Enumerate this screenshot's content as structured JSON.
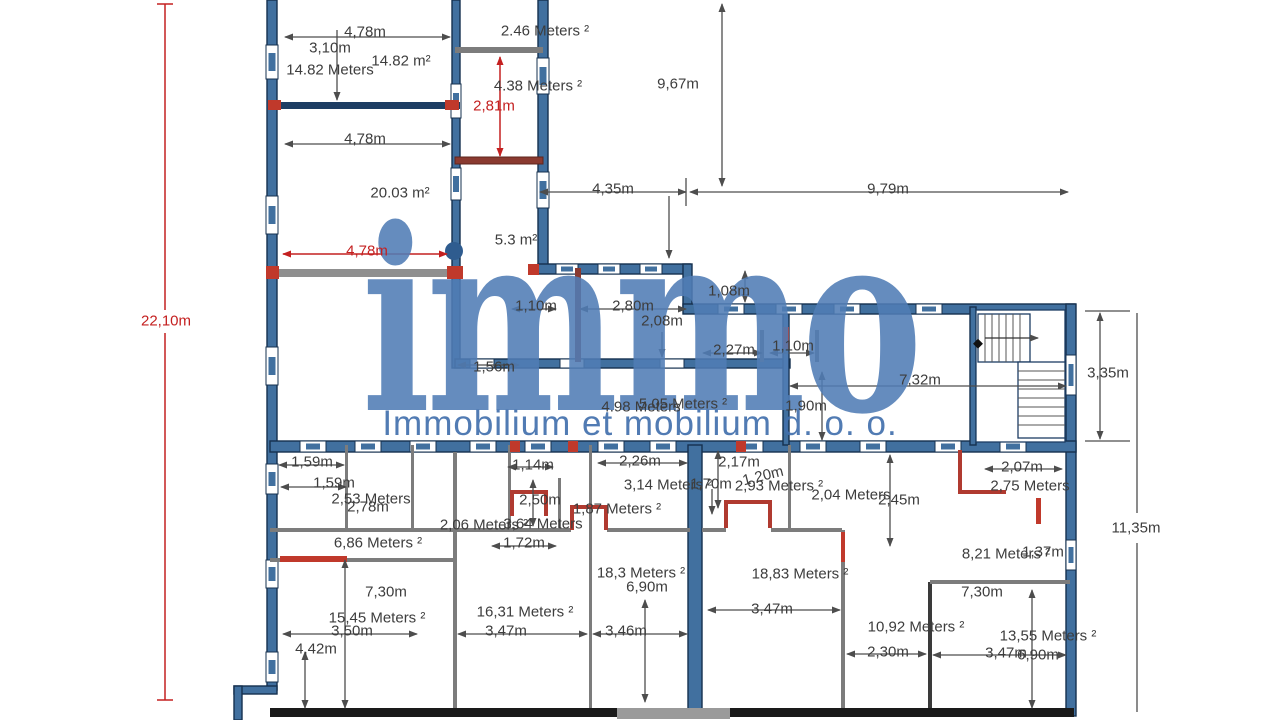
{
  "watermark": {
    "logo": "immo",
    "company": "Immobilium et mobilium d. o. o.",
    "color": "#4f7cb5"
  },
  "colors": {
    "wall_fill": "#41709f",
    "wall_stroke": "#15304f",
    "accent_red": "#a03a30",
    "dim_red": "#c42020",
    "dim_gray": "#4d4d4d"
  },
  "plan": {
    "labels": [
      {
        "text": "4,78m",
        "x": 365,
        "y": 32
      },
      {
        "text": "3,10m",
        "x": 330,
        "y": 48
      },
      {
        "text": "14.82 m²",
        "x": 401,
        "y": 61
      },
      {
        "text": "14.82 Meters",
        "x": 330,
        "y": 70
      },
      {
        "text": "2.46 Meters ²",
        "x": 545,
        "y": 31
      },
      {
        "text": "4.38 Meters ²",
        "x": 538,
        "y": 86
      },
      {
        "text": "2,81m",
        "x": 494,
        "y": 106,
        "red": true
      },
      {
        "text": "9,67m",
        "x": 678,
        "y": 84
      },
      {
        "text": "4,35m",
        "x": 613,
        "y": 189
      },
      {
        "text": "9,79m",
        "x": 888,
        "y": 189
      },
      {
        "text": "4,78m",
        "x": 365,
        "y": 139
      },
      {
        "text": "20.03 m²",
        "x": 400,
        "y": 193
      },
      {
        "text": "5.3 m²",
        "x": 516,
        "y": 240
      },
      {
        "text": "4,78m",
        "x": 367,
        "y": 251,
        "red": true
      },
      {
        "text": "22,10m",
        "x": 166,
        "y": 321,
        "red": true
      },
      {
        "text": "1,10m",
        "x": 536,
        "y": 306
      },
      {
        "text": "2,80m",
        "x": 633,
        "y": 306
      },
      {
        "text": "2,08m",
        "x": 662,
        "y": 321
      },
      {
        "text": "1,08m",
        "x": 729,
        "y": 291
      },
      {
        "text": "2,27m",
        "x": 734,
        "y": 350
      },
      {
        "text": "1,10m",
        "x": 793,
        "y": 346
      },
      {
        "text": "1,56m",
        "x": 494,
        "y": 367
      },
      {
        "text": "7,32m",
        "x": 920,
        "y": 380
      },
      {
        "text": "1,90m",
        "x": 806,
        "y": 406
      },
      {
        "text": "3,35m",
        "x": 1108,
        "y": 373
      },
      {
        "text": "11,35m",
        "x": 1136,
        "y": 528
      },
      {
        "text": "4.98 Meters",
        "x": 641,
        "y": 407
      },
      {
        "text": "5.05 Meters ²",
        "x": 683,
        "y": 404
      },
      {
        "text": "1,59m",
        "x": 312,
        "y": 462
      },
      {
        "text": "1,59m",
        "x": 334,
        "y": 483
      },
      {
        "text": "2,53 Meters",
        "x": 371,
        "y": 499
      },
      {
        "text": "2,78m",
        "x": 368,
        "y": 507
      },
      {
        "text": "6,86 Meters ²",
        "x": 378,
        "y": 543
      },
      {
        "text": "1,14m",
        "x": 533,
        "y": 465
      },
      {
        "text": "2,50m",
        "x": 540,
        "y": 500
      },
      {
        "text": "2,06 Meters ²",
        "x": 484,
        "y": 525
      },
      {
        "text": "3,64 Meters",
        "x": 543,
        "y": 524
      },
      {
        "text": "1,72m",
        "x": 524,
        "y": 543
      },
      {
        "text": "1,87 Meters ²",
        "x": 617,
        "y": 509
      },
      {
        "text": "2,26m",
        "x": 640,
        "y": 461
      },
      {
        "text": "3,14 Meters ²",
        "x": 668,
        "y": 485
      },
      {
        "text": "1,70m",
        "x": 711,
        "y": 484
      },
      {
        "text": "2,93 Meters ²",
        "x": 779,
        "y": 486
      },
      {
        "text": "2,17m",
        "x": 739,
        "y": 462
      },
      {
        "text": "1,20m",
        "x": 763,
        "y": 476,
        "rot": -14
      },
      {
        "text": "2,04 Meters",
        "x": 851,
        "y": 495
      },
      {
        "text": "2,45m",
        "x": 899,
        "y": 500
      },
      {
        "text": "2,07m",
        "x": 1022,
        "y": 467
      },
      {
        "text": "2,75 Meters",
        "x": 1030,
        "y": 486
      },
      {
        "text": "8,21 Meters ²",
        "x": 1006,
        "y": 554
      },
      {
        "text": "1,37m",
        "x": 1043,
        "y": 552
      },
      {
        "text": "18,3 Meters ²",
        "x": 641,
        "y": 573
      },
      {
        "text": "6,90m",
        "x": 647,
        "y": 587
      },
      {
        "text": "18,83 Meters ²",
        "x": 800,
        "y": 574
      },
      {
        "text": "3,47m",
        "x": 772,
        "y": 609
      },
      {
        "text": "7,30m",
        "x": 386,
        "y": 592
      },
      {
        "text": "15,45 Meters ²",
        "x": 377,
        "y": 618
      },
      {
        "text": "3,50m",
        "x": 352,
        "y": 631
      },
      {
        "text": "4,42m",
        "x": 316,
        "y": 649
      },
      {
        "text": "16,31 Meters ²",
        "x": 525,
        "y": 612
      },
      {
        "text": "3,47m",
        "x": 506,
        "y": 631
      },
      {
        "text": "3,46m",
        "x": 626,
        "y": 631
      },
      {
        "text": "10,92 Meters ²",
        "x": 916,
        "y": 627
      },
      {
        "text": "2,30m",
        "x": 888,
        "y": 652
      },
      {
        "text": "7,30m",
        "x": 982,
        "y": 592
      },
      {
        "text": "13,55 Meters ²",
        "x": 1048,
        "y": 636
      },
      {
        "text": "3,47m",
        "x": 1006,
        "y": 653
      },
      {
        "text": "6,90m",
        "x": 1038,
        "y": 655
      }
    ]
  }
}
